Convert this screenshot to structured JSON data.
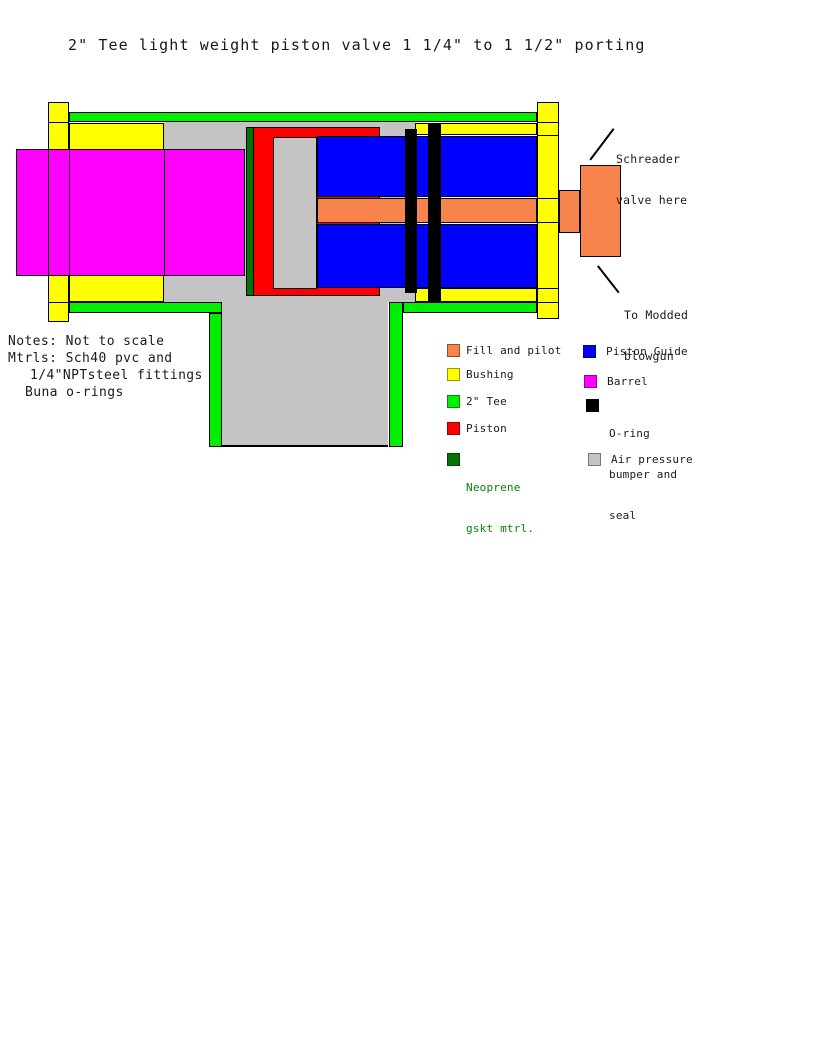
{
  "title": "2\" Tee light weight piston valve 1 1/4\" to 1 1/2\" porting",
  "notes": {
    "lines": [
      "Notes: Not to scale",
      "Mtrls: Sch40 pvc and",
      "1/4\"NPTsteel fittings",
      "Buna o-rings"
    ]
  },
  "annotations": {
    "schreader": {
      "lines": [
        "Schreader",
        "valve here"
      ]
    },
    "blowgun": {
      "lines": [
        "To Modded",
        "blowgun"
      ]
    }
  },
  "legend": {
    "left": [
      {
        "label": "Fill and pilot",
        "color": "#F7834D"
      },
      {
        "label": "Bushing",
        "color": "#FFFF00"
      },
      {
        "label": "2\" Tee",
        "color": "#00EE00"
      },
      {
        "label": "Piston",
        "color": "#FF0000"
      },
      {
        "lines": [
          "Neoprene",
          "gskt mtrl."
        ],
        "color": "#067306",
        "text_color": "#068206"
      }
    ],
    "right": [
      {
        "label": "Piston Guide",
        "color": "#0000FF"
      },
      {
        "label": "Barrel",
        "color": "#FF00FF"
      },
      {
        "lines": [
          "O-ring",
          "bumper and",
          "seal"
        ],
        "color": "#000000"
      },
      {
        "label": "Air pressure",
        "color": "#C4C4C4"
      }
    ]
  },
  "colors": {
    "tee_green": "#00EE00",
    "bushing_yellow": "#FFFF00",
    "barrel_magenta": "#FF00FF",
    "piston_red": "#FF0000",
    "guide_blue": "#0000FF",
    "pilot_orange": "#F7834D",
    "neoprene_green": "#067306",
    "air_gray": "#C4C4C4",
    "oring_black": "#000000",
    "outline": "#000000"
  }
}
